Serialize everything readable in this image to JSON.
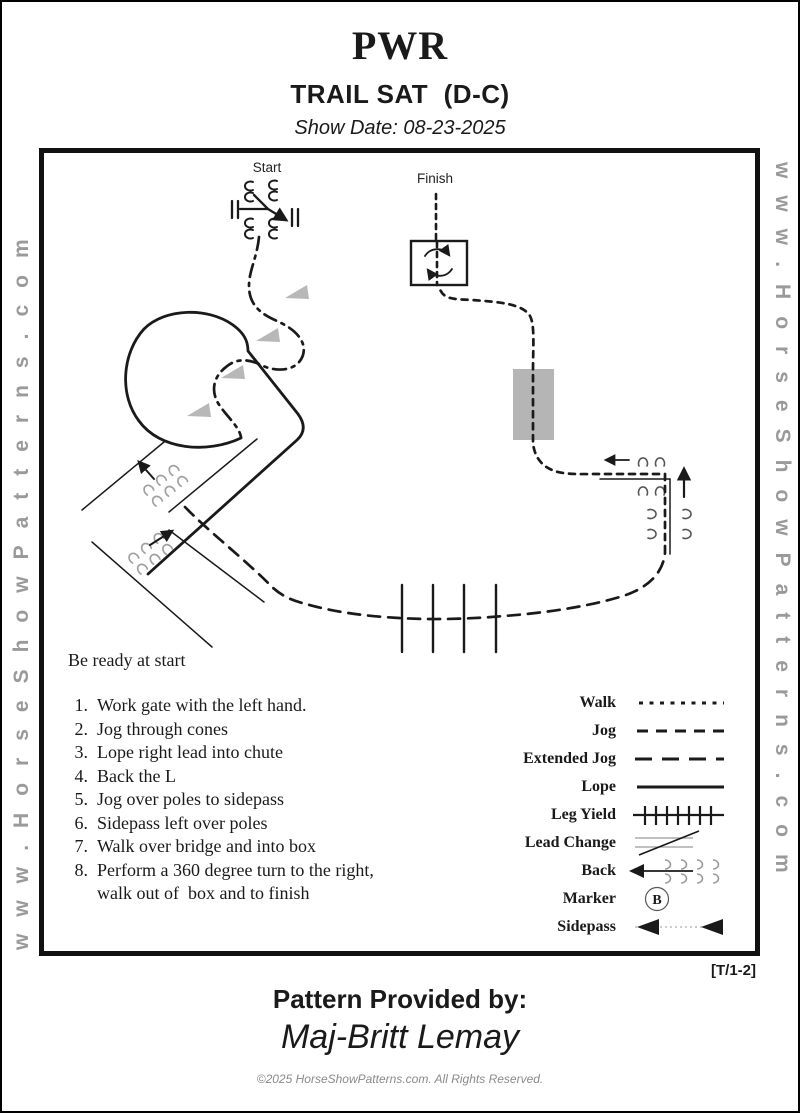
{
  "page": {
    "title": "PWR",
    "subtitle": "TRAIL SAT  (D-C)",
    "show_date": "Show Date: 08-23-2025",
    "watermark_left": "www.HorseShowPatterns.com",
    "watermark_right": "www.HorseShowPatterns.com",
    "pattern_code": "[T/1-2]",
    "footer": {
      "provided_by_label": "Pattern Provided by:",
      "provider_name": "Maj-Britt Lemay",
      "copyright": "©2025 HorseShowPatterns.com. All Rights Reserved."
    }
  },
  "diagram": {
    "start_label": "Start",
    "finish_label": "Finish",
    "ready_text": "Be ready at start",
    "instructions": [
      "Work gate with the left hand.",
      "Jog through cones",
      "Lope right lead into chute",
      "Back the L",
      "Jog over poles to sidepass",
      "Sidepass left over poles",
      "Walk over bridge and into box",
      "Perform a 360 degree turn to the right,\nwalk out of  box and to finish"
    ],
    "legend": {
      "items": [
        {
          "label": "Walk",
          "symbol": "walk"
        },
        {
          "label": "Jog",
          "symbol": "jog"
        },
        {
          "label": "Extended Jog",
          "symbol": "extended-jog"
        },
        {
          "label": "Lope",
          "symbol": "lope"
        },
        {
          "label": "Leg Yield",
          "symbol": "leg-yield"
        },
        {
          "label": "Lead Change",
          "symbol": "lead-change"
        },
        {
          "label": "Back",
          "symbol": "back"
        },
        {
          "label": "Marker",
          "symbol": "marker",
          "marker_letter": "B"
        },
        {
          "label": "Sidepass",
          "symbol": "sidepass"
        }
      ]
    }
  },
  "colors": {
    "ink": "#1a1a1a",
    "watermark_gray": "#9a9a9a",
    "cone_gray": "#b8b8b8",
    "bridge_gray": "#b5b5b5",
    "hoof_gray": "#a0a0a0"
  }
}
